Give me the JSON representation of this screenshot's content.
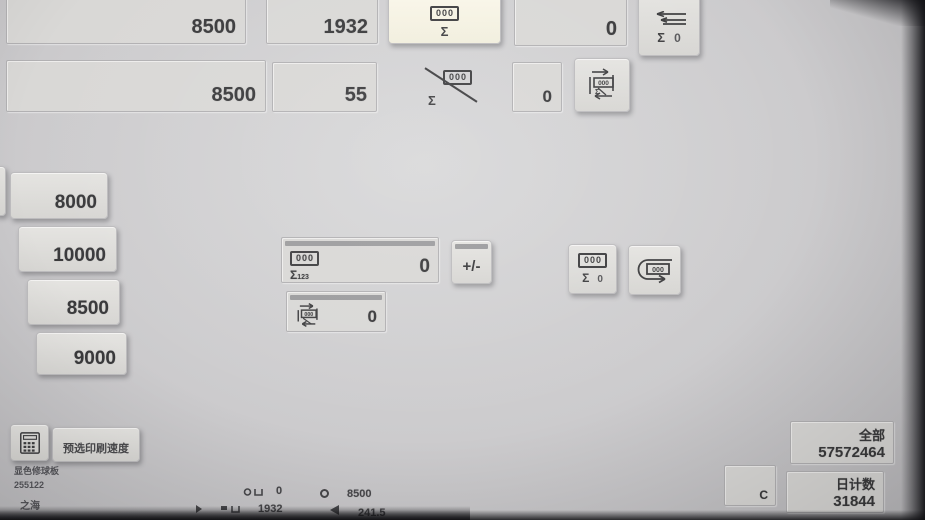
{
  "colors": {
    "background": "#cccbcd",
    "field": "#d9d8d6",
    "button": "#dedddb",
    "highlight_button": "#f8f5e6",
    "text": "#3a3a3c",
    "focus_strip": "#9c9c9e"
  },
  "top_left_fields": {
    "speed_field_1": "8500",
    "speed_field_2": "8500"
  },
  "top_counter_fields": {
    "impression_count": "1932",
    "small_count": "55",
    "right_count": "0",
    "small_right_count": "0"
  },
  "top_buttons": {
    "sum_counter": {
      "counter": "000",
      "sigma": "Σ"
    },
    "sum_crossed": {
      "counter": "000",
      "sigma": "Σ"
    },
    "arrows_sum_zero": {
      "sigma": "Σ",
      "value": "0"
    },
    "cycle_counter": {
      "counter": "000",
      "sigma": "Σ"
    }
  },
  "speed_presets": [
    {
      "label": "8000"
    },
    {
      "label": "10000"
    },
    {
      "label": "8500"
    },
    {
      "label": "9000"
    }
  ],
  "counter_panel": {
    "counter": "000",
    "sigma": "Σ",
    "sigma_sub": "123",
    "value": "0",
    "plus_minus_label": "+/-",
    "sub_counter": "000",
    "sub_value": "0"
  },
  "right_buttons": {
    "sum_zero": {
      "counter": "000",
      "sigma": "Σ",
      "value": "0"
    },
    "uturn_counter": {
      "counter": "000"
    }
  },
  "bottom_left": {
    "preset_speed_button": "预选印刷速度",
    "info_line_1": "显色修球板",
    "info_line_2": "255122",
    "info_line_3": "之海"
  },
  "bottom_right": {
    "total_label": "全部",
    "total_value": "57572464",
    "clear_button": "C",
    "daily_label": "日计数",
    "daily_value": "31844"
  },
  "status_bar": {
    "row1_count": "0",
    "row1_speed": "8500",
    "row2_count": "1932",
    "row2_value": "241.5"
  }
}
